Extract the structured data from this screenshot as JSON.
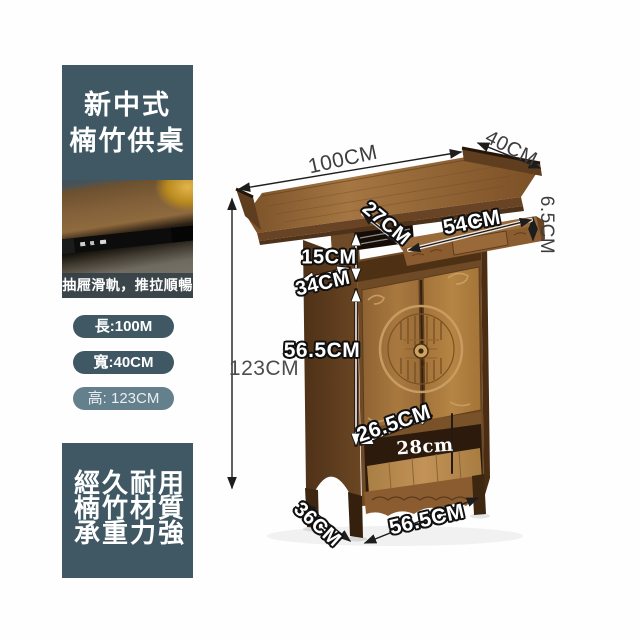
{
  "sidebar": {
    "title_box": {
      "line1": "新中式",
      "line2": "楠竹供桌"
    },
    "photo_caption": "抽屜滑軌，推拉順暢",
    "pills": [
      {
        "text": "長:100M"
      },
      {
        "text": "寬:40CM"
      },
      {
        "text": "高: 123CM"
      }
    ],
    "feature_box": {
      "line1": "經久耐用",
      "line2": "楠竹材質",
      "line3": "承重力強"
    }
  },
  "diagram": {
    "labels": {
      "top_length": "100CM",
      "top_depth": "40CM",
      "tier_front_depth": "27CM",
      "tier_length": "54CM",
      "tier_thickness": "6.5CM",
      "gap_height": "15CM",
      "cabinet_depth": "34CM",
      "cabinet_height": "56.5CM",
      "total_height": "123CM",
      "bottom_shelf_height": "26.5CM",
      "shelf_inner_height": "28cm",
      "base_depth": "36CM",
      "base_width": "56.5CM"
    }
  },
  "colors": {
    "accent_slate": "#3f5864",
    "accent_slate_light": "#64808d",
    "wood_main": "#8a5f33",
    "dimension_line": "#1d1d1d"
  }
}
